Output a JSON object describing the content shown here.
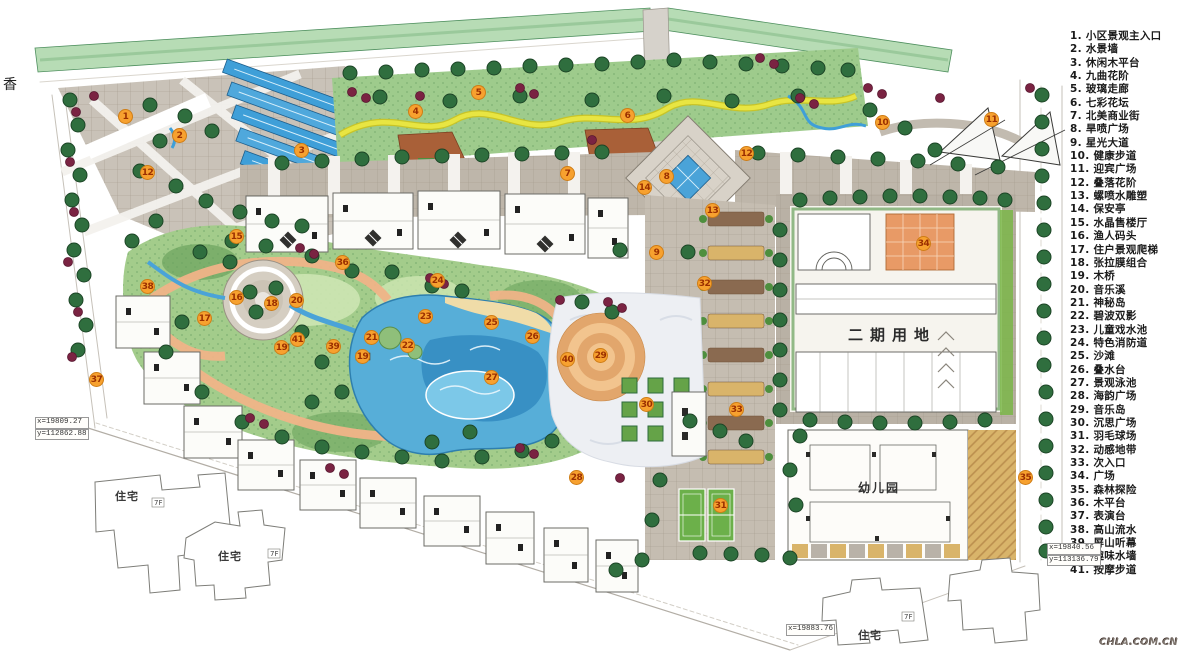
{
  "title": "小区景观总平面图",
  "legend": {
    "items": [
      {
        "n": "1",
        "label": "小区景观主入口"
      },
      {
        "n": "2",
        "label": "水景墙"
      },
      {
        "n": "3",
        "label": "休闲木平台"
      },
      {
        "n": "4",
        "label": "九曲花阶"
      },
      {
        "n": "5",
        "label": "玻璃走廊"
      },
      {
        "n": "6",
        "label": "七彩花坛"
      },
      {
        "n": "7",
        "label": "北美商业街"
      },
      {
        "n": "8",
        "label": "旱喷广场"
      },
      {
        "n": "9",
        "label": "星光大道"
      },
      {
        "n": "10",
        "label": "健康步道"
      },
      {
        "n": "11",
        "label": "迎宾广场"
      },
      {
        "n": "12",
        "label": "叠落花阶"
      },
      {
        "n": "13",
        "label": "螺喷水雕塑"
      },
      {
        "n": "14",
        "label": "保安亭"
      },
      {
        "n": "15",
        "label": "水晶售楼厅"
      },
      {
        "n": "16",
        "label": "渔人码头"
      },
      {
        "n": "17",
        "label": "住户景观爬梯"
      },
      {
        "n": "18",
        "label": "张拉膜组合"
      },
      {
        "n": "19",
        "label": "木桥"
      },
      {
        "n": "20",
        "label": "音乐溪"
      },
      {
        "n": "21",
        "label": "神秘岛"
      },
      {
        "n": "22",
        "label": "碧波双影"
      },
      {
        "n": "23",
        "label": "儿童戏水池"
      },
      {
        "n": "24",
        "label": "特色消防道"
      },
      {
        "n": "25",
        "label": "沙滩"
      },
      {
        "n": "26",
        "label": "叠水台"
      },
      {
        "n": "27",
        "label": "景观泳池"
      },
      {
        "n": "28",
        "label": "海韵广场"
      },
      {
        "n": "29",
        "label": "音乐岛"
      },
      {
        "n": "30",
        "label": "沉思广场"
      },
      {
        "n": "31",
        "label": "羽毛球场"
      },
      {
        "n": "32",
        "label": "动感地带"
      },
      {
        "n": "33",
        "label": "次入口"
      },
      {
        "n": "34",
        "label": "广场"
      },
      {
        "n": "35",
        "label": "森林探险"
      },
      {
        "n": "36",
        "label": "木平台"
      },
      {
        "n": "37",
        "label": "表演台"
      },
      {
        "n": "38",
        "label": "高山流水"
      },
      {
        "n": "39",
        "label": "屏山听幕"
      },
      {
        "n": "40",
        "label": "趣味水墙"
      },
      {
        "n": "41",
        "label": "按摩步道"
      }
    ]
  },
  "plan": {
    "phase2_label": "二期用地",
    "kindergarten_label": "幼儿园",
    "residential_label": "住宅",
    "floor_label": "7F",
    "street_label": "香"
  },
  "coords": {
    "left_x": "x=19809.27",
    "left_y": "y=112862.88",
    "right_x": "x=19840.56",
    "right_y": "y=113136.79",
    "bottom_x": "x=19883.76"
  },
  "watermark": "CHLA.COM.CN",
  "colors": {
    "marker_fill": "#f7a12f",
    "marker_text": "#9b2f00",
    "water": "#57aed8",
    "deep_water": "#2e86bd",
    "lawn": "#a3cc8b",
    "tree": "#2f6e3e",
    "shrub_red": "#7a2342",
    "paving_gray": "#beb6aa",
    "paving_tan": "#d9b46a",
    "path_orange": "#f0b488",
    "belt_green": "#b7dcb5"
  },
  "markers": [
    {
      "n": "1",
      "x": 126,
      "y": 117
    },
    {
      "n": "2",
      "x": 180,
      "y": 136
    },
    {
      "n": "3",
      "x": 302,
      "y": 151
    },
    {
      "n": "4",
      "x": 416,
      "y": 112
    },
    {
      "n": "5",
      "x": 479,
      "y": 93
    },
    {
      "n": "6",
      "x": 628,
      "y": 116
    },
    {
      "n": "7",
      "x": 568,
      "y": 174
    },
    {
      "n": "8",
      "x": 667,
      "y": 177
    },
    {
      "n": "9",
      "x": 657,
      "y": 253
    },
    {
      "n": "10",
      "x": 883,
      "y": 123
    },
    {
      "n": "11",
      "x": 992,
      "y": 120
    },
    {
      "n": "12",
      "x": 148,
      "y": 173
    },
    {
      "n": "12",
      "x": 747,
      "y": 154
    },
    {
      "n": "13",
      "x": 713,
      "y": 211
    },
    {
      "n": "14",
      "x": 645,
      "y": 188
    },
    {
      "n": "15",
      "x": 237,
      "y": 237
    },
    {
      "n": "16",
      "x": 237,
      "y": 298
    },
    {
      "n": "17",
      "x": 205,
      "y": 319
    },
    {
      "n": "18",
      "x": 272,
      "y": 304
    },
    {
      "n": "19",
      "x": 282,
      "y": 348
    },
    {
      "n": "19",
      "x": 363,
      "y": 357
    },
    {
      "n": "20",
      "x": 297,
      "y": 301
    },
    {
      "n": "21",
      "x": 372,
      "y": 338
    },
    {
      "n": "22",
      "x": 408,
      "y": 346
    },
    {
      "n": "23",
      "x": 426,
      "y": 317
    },
    {
      "n": "24",
      "x": 438,
      "y": 281
    },
    {
      "n": "25",
      "x": 492,
      "y": 323
    },
    {
      "n": "26",
      "x": 533,
      "y": 337
    },
    {
      "n": "27",
      "x": 492,
      "y": 378
    },
    {
      "n": "28",
      "x": 577,
      "y": 478
    },
    {
      "n": "29",
      "x": 601,
      "y": 356
    },
    {
      "n": "30",
      "x": 647,
      "y": 405
    },
    {
      "n": "31",
      "x": 721,
      "y": 506
    },
    {
      "n": "32",
      "x": 705,
      "y": 284
    },
    {
      "n": "33",
      "x": 737,
      "y": 410
    },
    {
      "n": "34",
      "x": 924,
      "y": 244
    },
    {
      "n": "35",
      "x": 1026,
      "y": 478
    },
    {
      "n": "36",
      "x": 343,
      "y": 263
    },
    {
      "n": "37",
      "x": 97,
      "y": 380
    },
    {
      "n": "38",
      "x": 148,
      "y": 287
    },
    {
      "n": "39",
      "x": 334,
      "y": 347
    },
    {
      "n": "40",
      "x": 568,
      "y": 360
    },
    {
      "n": "41",
      "x": 298,
      "y": 340
    }
  ]
}
